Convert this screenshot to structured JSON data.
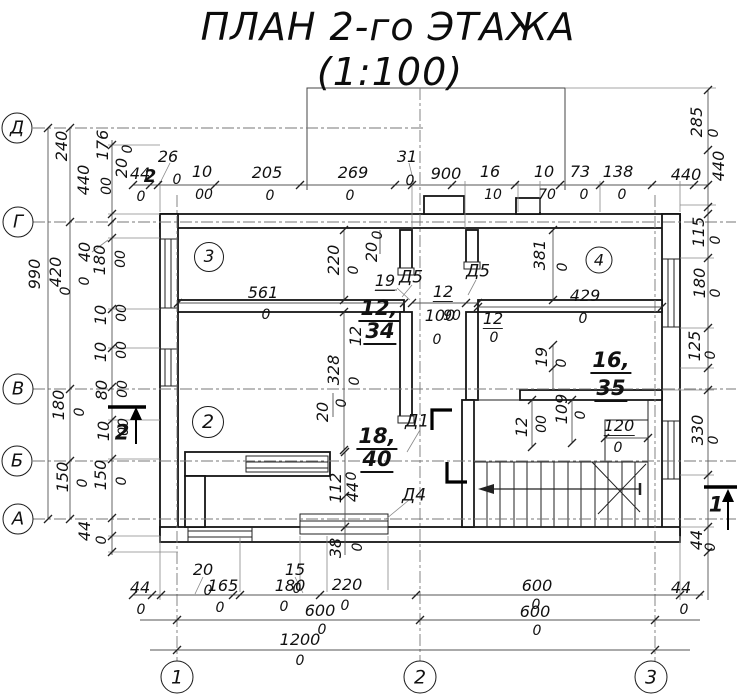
{
  "title": {
    "line1": "ПЛАН 2-го ЭТАЖА",
    "line2": "(1:100)",
    "scale": "1:100",
    "floor": "2"
  },
  "axes": {
    "horizontal": [
      "Д",
      "Г",
      "В",
      "Б",
      "А"
    ],
    "vertical": [
      "1",
      "2",
      "3"
    ]
  },
  "rooms": [
    {
      "number": "3",
      "area": "12,34"
    },
    {
      "number": "2",
      "area": "18,40"
    },
    {
      "number": "4",
      "area": "16,35"
    }
  ],
  "doors": [
    "Д5",
    "Д5",
    "Д1",
    "Д4"
  ],
  "section_marks": [
    "1",
    "2"
  ],
  "axis_circles": [
    {
      "t": "Д",
      "x": 17,
      "y": 128,
      "d": 31
    },
    {
      "t": "Г",
      "x": 18,
      "y": 222,
      "d": 31
    },
    {
      "t": "В",
      "x": 18,
      "y": 389,
      "d": 31
    },
    {
      "t": "Б",
      "x": 17,
      "y": 461,
      "d": 31
    },
    {
      "t": "А",
      "x": 18,
      "y": 519,
      "d": 31
    },
    {
      "t": "1",
      "x": 177,
      "y": 677,
      "d": 33
    },
    {
      "t": "2",
      "x": 420,
      "y": 677,
      "d": 33
    },
    {
      "t": "3",
      "x": 651,
      "y": 677,
      "d": 33
    },
    {
      "t": "3",
      "x": 209,
      "y": 257,
      "d": 30
    },
    {
      "t": "2",
      "x": 208,
      "y": 422,
      "d": 32
    },
    {
      "t": "4",
      "x": 599,
      "y": 260,
      "d": 27
    }
  ],
  "labels": [
    {
      "t": "ПЛАН 2-го ЭТАЖА",
      "x": 388,
      "y": 27,
      "s": 38,
      "c": "t",
      "n": "title-line1"
    },
    {
      "t": "(1:100)",
      "x": 390,
      "y": 72,
      "s": 38,
      "c": "t",
      "n": "title-line2"
    },
    {
      "t": "44",
      "x": 140,
      "y": 174
    },
    {
      "t": "0",
      "x": 141,
      "y": 197,
      "s": 14
    },
    {
      "t": "26",
      "x": 168,
      "y": 157
    },
    {
      "t": "0",
      "x": 177,
      "y": 180,
      "s": 14
    },
    {
      "t": "10",
      "x": 202,
      "y": 172
    },
    {
      "t": "00",
      "x": 204,
      "y": 195,
      "s": 14
    },
    {
      "t": "205",
      "x": 267,
      "y": 173
    },
    {
      "t": "0",
      "x": 270,
      "y": 196,
      "s": 14
    },
    {
      "t": "269",
      "x": 353,
      "y": 173
    },
    {
      "t": "0",
      "x": 350,
      "y": 196,
      "s": 14
    },
    {
      "t": "31",
      "x": 407,
      "y": 157
    },
    {
      "t": "0",
      "x": 410,
      "y": 181,
      "s": 14
    },
    {
      "t": "900",
      "x": 446,
      "y": 174
    },
    {
      "t": "16",
      "x": 490,
      "y": 172
    },
    {
      "t": "10",
      "x": 493,
      "y": 195,
      "s": 14
    },
    {
      "t": "10",
      "x": 544,
      "y": 172
    },
    {
      "t": "70",
      "x": 547,
      "y": 195,
      "s": 14
    },
    {
      "t": "73",
      "x": 580,
      "y": 172
    },
    {
      "t": "0",
      "x": 584,
      "y": 195,
      "s": 14
    },
    {
      "t": "138",
      "x": 618,
      "y": 172
    },
    {
      "t": "0",
      "x": 622,
      "y": 195,
      "s": 14
    },
    {
      "t": "440",
      "x": 686,
      "y": 175
    },
    {
      "t": "2",
      "x": 150,
      "y": 177,
      "s": 18,
      "c": "sec",
      "n": "section-label"
    },
    {
      "t": "285",
      "x": 697,
      "y": 122,
      "r": 1
    },
    {
      "t": "0",
      "x": 714,
      "y": 133,
      "r": 1,
      "s": 14
    },
    {
      "t": "440",
      "x": 719,
      "y": 166,
      "r": 1
    },
    {
      "t": "115",
      "x": 699,
      "y": 232,
      "r": 1
    },
    {
      "t": "0",
      "x": 716,
      "y": 240,
      "r": 1,
      "s": 14
    },
    {
      "t": "180",
      "x": 700,
      "y": 283,
      "r": 1
    },
    {
      "t": "0",
      "x": 716,
      "y": 293,
      "r": 1,
      "s": 14
    },
    {
      "t": "125",
      "x": 695,
      "y": 346,
      "r": 1
    },
    {
      "t": "0",
      "x": 711,
      "y": 355,
      "r": 1,
      "s": 14
    },
    {
      "t": "330",
      "x": 698,
      "y": 430,
      "r": 1
    },
    {
      "t": "0",
      "x": 714,
      "y": 440,
      "r": 1,
      "s": 14
    },
    {
      "t": "1",
      "x": 716,
      "y": 505,
      "s": 21,
      "c": "sec",
      "n": "section-label"
    },
    {
      "t": "44",
      "x": 697,
      "y": 540,
      "r": 1
    },
    {
      "t": "0",
      "x": 711,
      "y": 547,
      "r": 1,
      "s": 14
    },
    {
      "t": "44",
      "x": 681,
      "y": 588
    },
    {
      "t": "0",
      "x": 684,
      "y": 610,
      "s": 14
    },
    {
      "t": "990",
      "x": 35,
      "y": 274,
      "r": 1
    },
    {
      "t": "240",
      "x": 62,
      "y": 146,
      "r": 1
    },
    {
      "t": "440",
      "x": 84,
      "y": 180,
      "r": 1
    },
    {
      "t": "176",
      "x": 103,
      "y": 145,
      "r": 1
    },
    {
      "t": "00",
      "x": 107,
      "y": 186,
      "r": 1,
      "s": 14
    },
    {
      "t": "20",
      "x": 122,
      "y": 168,
      "r": 1
    },
    {
      "t": "0",
      "x": 128,
      "y": 149,
      "r": 1,
      "s": 14
    },
    {
      "t": "420",
      "x": 56,
      "y": 272,
      "r": 1
    },
    {
      "t": "0",
      "x": 66,
      "y": 291,
      "r": 1,
      "s": 14
    },
    {
      "t": "40",
      "x": 85,
      "y": 252,
      "r": 1
    },
    {
      "t": "0",
      "x": 85,
      "y": 281,
      "r": 1,
      "s": 14
    },
    {
      "t": "180",
      "x": 100,
      "y": 260,
      "r": 1
    },
    {
      "t": "00",
      "x": 121,
      "y": 259,
      "r": 1,
      "s": 14
    },
    {
      "t": "10",
      "x": 101,
      "y": 315,
      "r": 1
    },
    {
      "t": "00",
      "x": 122,
      "y": 313,
      "r": 1,
      "s": 14
    },
    {
      "t": "10",
      "x": 101,
      "y": 352,
      "r": 1
    },
    {
      "t": "00",
      "x": 122,
      "y": 350,
      "r": 1,
      "s": 14
    },
    {
      "t": "80",
      "x": 102,
      "y": 390,
      "r": 1
    },
    {
      "t": "00",
      "x": 123,
      "y": 389,
      "r": 1,
      "s": 14
    },
    {
      "t": "10",
      "x": 104,
      "y": 431,
      "r": 1
    },
    {
      "t": "00",
      "x": 124,
      "y": 427,
      "r": 1,
      "s": 14
    },
    {
      "t": "2",
      "x": 122,
      "y": 433,
      "s": 21,
      "c": "sec",
      "n": "section-label"
    },
    {
      "t": "180",
      "x": 59,
      "y": 405,
      "r": 1
    },
    {
      "t": "0",
      "x": 80,
      "y": 412,
      "r": 1,
      "s": 14
    },
    {
      "t": "150",
      "x": 63,
      "y": 477,
      "r": 1
    },
    {
      "t": "0",
      "x": 83,
      "y": 483,
      "r": 1,
      "s": 14
    },
    {
      "t": "150",
      "x": 101,
      "y": 475,
      "r": 1
    },
    {
      "t": "0",
      "x": 122,
      "y": 481,
      "r": 1,
      "s": 14
    },
    {
      "t": "44",
      "x": 85,
      "y": 531,
      "r": 1
    },
    {
      "t": "0",
      "x": 102,
      "y": 540,
      "r": 1,
      "s": 14
    },
    {
      "t": "44",
      "x": 140,
      "y": 588
    },
    {
      "t": "0",
      "x": 141,
      "y": 610,
      "s": 14
    },
    {
      "t": "20",
      "x": 203,
      "y": 570
    },
    {
      "t": "0",
      "x": 208,
      "y": 591,
      "s": 14
    },
    {
      "t": "165",
      "x": 223,
      "y": 586
    },
    {
      "t": "0",
      "x": 220,
      "y": 608,
      "s": 14
    },
    {
      "t": "15",
      "x": 295,
      "y": 570
    },
    {
      "t": "0",
      "x": 297,
      "y": 589,
      "s": 14
    },
    {
      "t": "180",
      "x": 290,
      "y": 586
    },
    {
      "t": "0",
      "x": 284,
      "y": 607,
      "s": 14
    },
    {
      "t": "220",
      "x": 347,
      "y": 585
    },
    {
      "t": "0",
      "x": 345,
      "y": 606,
      "s": 14
    },
    {
      "t": "600",
      "x": 537,
      "y": 586
    },
    {
      "t": "0",
      "x": 536,
      "y": 605,
      "s": 14
    },
    {
      "t": "600",
      "x": 320,
      "y": 611
    },
    {
      "t": "0",
      "x": 322,
      "y": 630,
      "s": 14
    },
    {
      "t": "600",
      "x": 535,
      "y": 612
    },
    {
      "t": "0",
      "x": 537,
      "y": 631,
      "s": 14
    },
    {
      "t": "1200",
      "x": 300,
      "y": 640
    },
    {
      "t": "0",
      "x": 300,
      "y": 661,
      "s": 14
    },
    {
      "t": "561",
      "x": 263,
      "y": 293
    },
    {
      "t": "0",
      "x": 266,
      "y": 315,
      "s": 14
    },
    {
      "t": "220",
      "x": 334,
      "y": 260,
      "r": 1
    },
    {
      "t": "0",
      "x": 354,
      "y": 270,
      "r": 1,
      "s": 14
    },
    {
      "t": "20",
      "x": 372,
      "y": 252,
      "r": 1
    },
    {
      "t": "0",
      "x": 378,
      "y": 235,
      "r": 1,
      "s": 14
    },
    {
      "t": "19",
      "x": 385,
      "y": 282,
      "c": "u"
    },
    {
      "t": "12",
      "x": 356,
      "y": 336,
      "r": 1
    },
    {
      "t": "12,",
      "x": 379,
      "y": 310,
      "s": 21,
      "c": "b",
      "n": "area-label"
    },
    {
      "t": "34",
      "x": 380,
      "y": 333,
      "s": 21,
      "c": "b",
      "n": "area-label"
    },
    {
      "t": "Д5",
      "x": 411,
      "y": 278,
      "s": 17,
      "n": "door-label"
    },
    {
      "t": "Д5",
      "x": 478,
      "y": 272,
      "s": 17,
      "n": "door-label"
    },
    {
      "t": "12",
      "x": 443,
      "y": 293,
      "c": "u"
    },
    {
      "t": "100",
      "x": 440,
      "y": 316
    },
    {
      "t": "90",
      "x": 452,
      "y": 316,
      "s": 14
    },
    {
      "t": "0",
      "x": 437,
      "y": 340,
      "s": 14
    },
    {
      "t": "12",
      "x": 493,
      "y": 320,
      "c": "u"
    },
    {
      "t": "0",
      "x": 494,
      "y": 338,
      "s": 14
    },
    {
      "t": "429",
      "x": 585,
      "y": 296
    },
    {
      "t": "0",
      "x": 583,
      "y": 319,
      "s": 14
    },
    {
      "t": "381",
      "x": 540,
      "y": 255,
      "r": 1
    },
    {
      "t": "0",
      "x": 563,
      "y": 267,
      "r": 1,
      "s": 14
    },
    {
      "t": "19",
      "x": 542,
      "y": 357,
      "r": 1
    },
    {
      "t": "0",
      "x": 562,
      "y": 363,
      "r": 1,
      "s": 14
    },
    {
      "t": "16,",
      "x": 611,
      "y": 362,
      "s": 21,
      "c": "b",
      "n": "area-label"
    },
    {
      "t": "35",
      "x": 611,
      "y": 390,
      "s": 21,
      "c": "b",
      "n": "area-label"
    },
    {
      "t": "328",
      "x": 334,
      "y": 370,
      "r": 1
    },
    {
      "t": "0",
      "x": 355,
      "y": 381,
      "r": 1,
      "s": 14
    },
    {
      "t": "20",
      "x": 323,
      "y": 412,
      "r": 1
    },
    {
      "t": "0",
      "x": 342,
      "y": 403,
      "r": 1,
      "s": 14
    },
    {
      "t": "18,",
      "x": 377,
      "y": 438,
      "s": 21,
      "c": "b",
      "n": "area-label"
    },
    {
      "t": "40",
      "x": 377,
      "y": 461,
      "s": 21,
      "c": "b",
      "n": "area-label"
    },
    {
      "t": "Д1",
      "x": 417,
      "y": 422,
      "s": 17,
      "n": "door-label"
    },
    {
      "t": "Д4",
      "x": 414,
      "y": 496,
      "s": 17,
      "n": "door-label"
    },
    {
      "t": "112",
      "x": 336,
      "y": 488,
      "r": 1
    },
    {
      "t": "44",
      "x": 353,
      "y": 492,
      "r": 1
    },
    {
      "t": "0",
      "x": 352,
      "y": 476,
      "r": 1,
      "s": 14
    },
    {
      "t": "38",
      "x": 336,
      "y": 548,
      "r": 1
    },
    {
      "t": "0",
      "x": 358,
      "y": 547,
      "r": 1,
      "s": 14
    },
    {
      "t": "12",
      "x": 522,
      "y": 427,
      "r": 1
    },
    {
      "t": "00",
      "x": 542,
      "y": 424,
      "r": 1,
      "s": 14
    },
    {
      "t": "109",
      "x": 562,
      "y": 409,
      "r": 1
    },
    {
      "t": "0",
      "x": 581,
      "y": 415,
      "r": 1,
      "s": 14
    },
    {
      "t": "120",
      "x": 619,
      "y": 427,
      "c": "u"
    },
    {
      "t": "0",
      "x": 618,
      "y": 448,
      "s": 14
    }
  ]
}
